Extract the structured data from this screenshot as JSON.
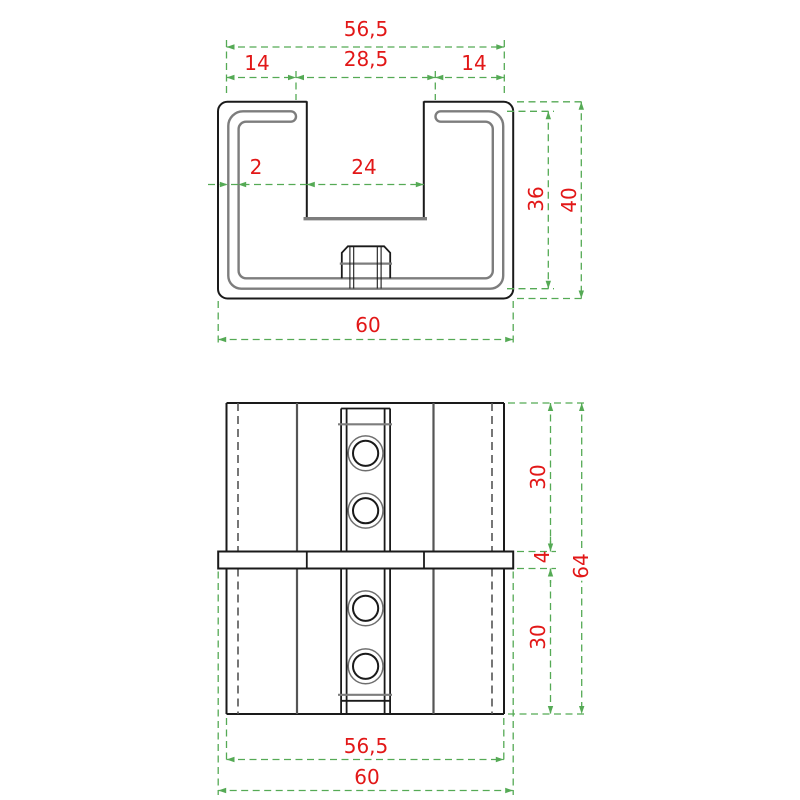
{
  "colors": {
    "outline": "#1a1a1a",
    "profile_gray": "#7d7d7d",
    "hidden_line": "#555555",
    "dimension_line": "#55aa55",
    "dimension_text": "#e21717",
    "background": "#ffffff"
  },
  "top_view": {
    "description": "section view of C-channel end cap on profile tube",
    "dims": {
      "tube_width": "56,5",
      "lip_left": "14",
      "mouth_outer": "28,5",
      "lip_right": "14",
      "wall_thickness": "2",
      "mouth_inner": "24",
      "tube_height": "36",
      "overall_height": "40",
      "overall_width": "60"
    }
  },
  "front_view": {
    "description": "front view with flange band and four screw holes",
    "dims": {
      "upper_section": "30",
      "flange_thickness": "4",
      "lower_section": "30",
      "overall_height": "64",
      "body_width": "56,5",
      "flange_width": "60"
    }
  }
}
